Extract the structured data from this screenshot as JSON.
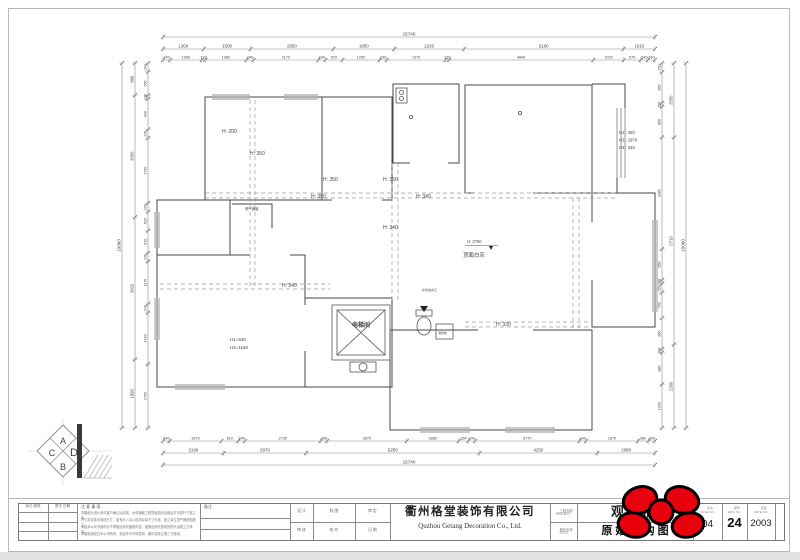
{
  "title_block": {
    "revision": {
      "col1_header": "标记 修改",
      "col2_header": "签字 日期"
    },
    "notes": {
      "header": "注 意 事 项 :",
      "lines": [
        "本图纸为设计师与客户确认后绘制，水电隐蔽工程须经验收合格后方可进行下道工序。",
        "开工前请核对现场尺寸，如有出入请以现场实际尺寸为准，施工单位须严格按图施工。",
        "未经本公司书面同意不得擅自修改图纸内容，因擅自修改造成的损失由施工方承担。",
        "本图纸版权归本公司所有，未经许可不得复制、翻印或转让第三方使用。"
      ]
    },
    "remark": {
      "header": "备注"
    },
    "staff_cells": {
      "r1c1": "设 计",
      "r1c2": "制 图",
      "r1c3": "审 定",
      "r2c1": "审 核",
      "r2c2": "校 对",
      "r2c3": "日 期"
    },
    "company": {
      "cn": "衢州格堂装饰有限公司",
      "en": "Quzhou Getang Decoration Co., Ltd."
    },
    "name_labels": {
      "project_cn": "工程名称",
      "project_en": "PROJECT",
      "drawing_cn": "图纸名称",
      "drawing_en": "TITLE"
    },
    "project_name": "观棠府",
    "drawing_name": "原 始 结 构 图",
    "numbers": {
      "page": {
        "header": "页次",
        "sub": "PAGE NO.",
        "value": "04"
      },
      "dwg": {
        "header": "图号",
        "sub": "DWG NO.",
        "value": "24"
      },
      "date": {
        "header": "日期",
        "sub": "DATE NO.",
        "value": "2003"
      }
    }
  },
  "logo": {
    "letters": {
      "a": "A",
      "d": "D",
      "c": "C",
      "b": "B"
    }
  },
  "plan_labels": {
    "h200": "H: 200",
    "h350a": "H: 350",
    "h350b": "H: 350",
    "h350c": "H: 350",
    "h350d": "H: 350",
    "h340a": "H: 340",
    "h340b": "H: 340",
    "h340c": "H: 340",
    "h330": "H: 330",
    "ceiling_height": "H: 2760",
    "ceiling_note": "顶面白灰",
    "right_h1": "H1 : 450",
    "right_h2": "H2 : 1970",
    "right_h3": "H3 : 340",
    "win_h1": "H1=940",
    "win_h2": "H2=1160",
    "elevator": "电梯间",
    "gas_pipe": "燃气管道",
    "water_inlet": "水管进水口",
    "hydrant": "消防栓"
  },
  "dimensions": {
    "top": {
      "total": [
        "15740"
      ],
      "mid": [
        "1300",
        "1500",
        "2650",
        "1950",
        "2230",
        "5100",
        "1010"
      ],
      "detail": [
        "240",
        "1060",
        "120",
        "1380",
        "240",
        "2170",
        "240",
        "570",
        "1250",
        "240",
        "1970",
        "120",
        "4840",
        "1020",
        "570",
        "240",
        "240"
      ]
    },
    "bottom": {
      "detail": [
        "240",
        "1870",
        "610",
        "240",
        "2730",
        "240",
        "2870",
        "1880",
        "350",
        "240",
        "3770",
        "240",
        "1870",
        "380",
        "240"
      ],
      "mid": [
        "2190",
        "2970",
        "6250",
        "4250",
        "2080"
      ],
      "total": [
        "15740"
      ]
    },
    "left": {
      "total": [
        "10060"
      ],
      "mid": [
        "890",
        "3360",
        "3920",
        "1890"
      ],
      "detail": [
        "240",
        "650",
        "100",
        "840",
        "240",
        "1790",
        "240",
        "520",
        "610",
        "240",
        "1170",
        "240",
        "1420",
        "1760"
      ]
    },
    "right": {
      "detail": [
        "250",
        "850",
        "100",
        "850",
        "3080",
        "850",
        "100",
        "250",
        "700",
        "850",
        "100",
        "880",
        "1200"
      ],
      "mid": [
        "2050",
        "5710",
        "2300"
      ],
      "total": [
        "10060"
      ]
    }
  },
  "colors": {
    "wall_line": "#474747",
    "dim_line": "#777777",
    "accent_red": "#e8000d"
  }
}
